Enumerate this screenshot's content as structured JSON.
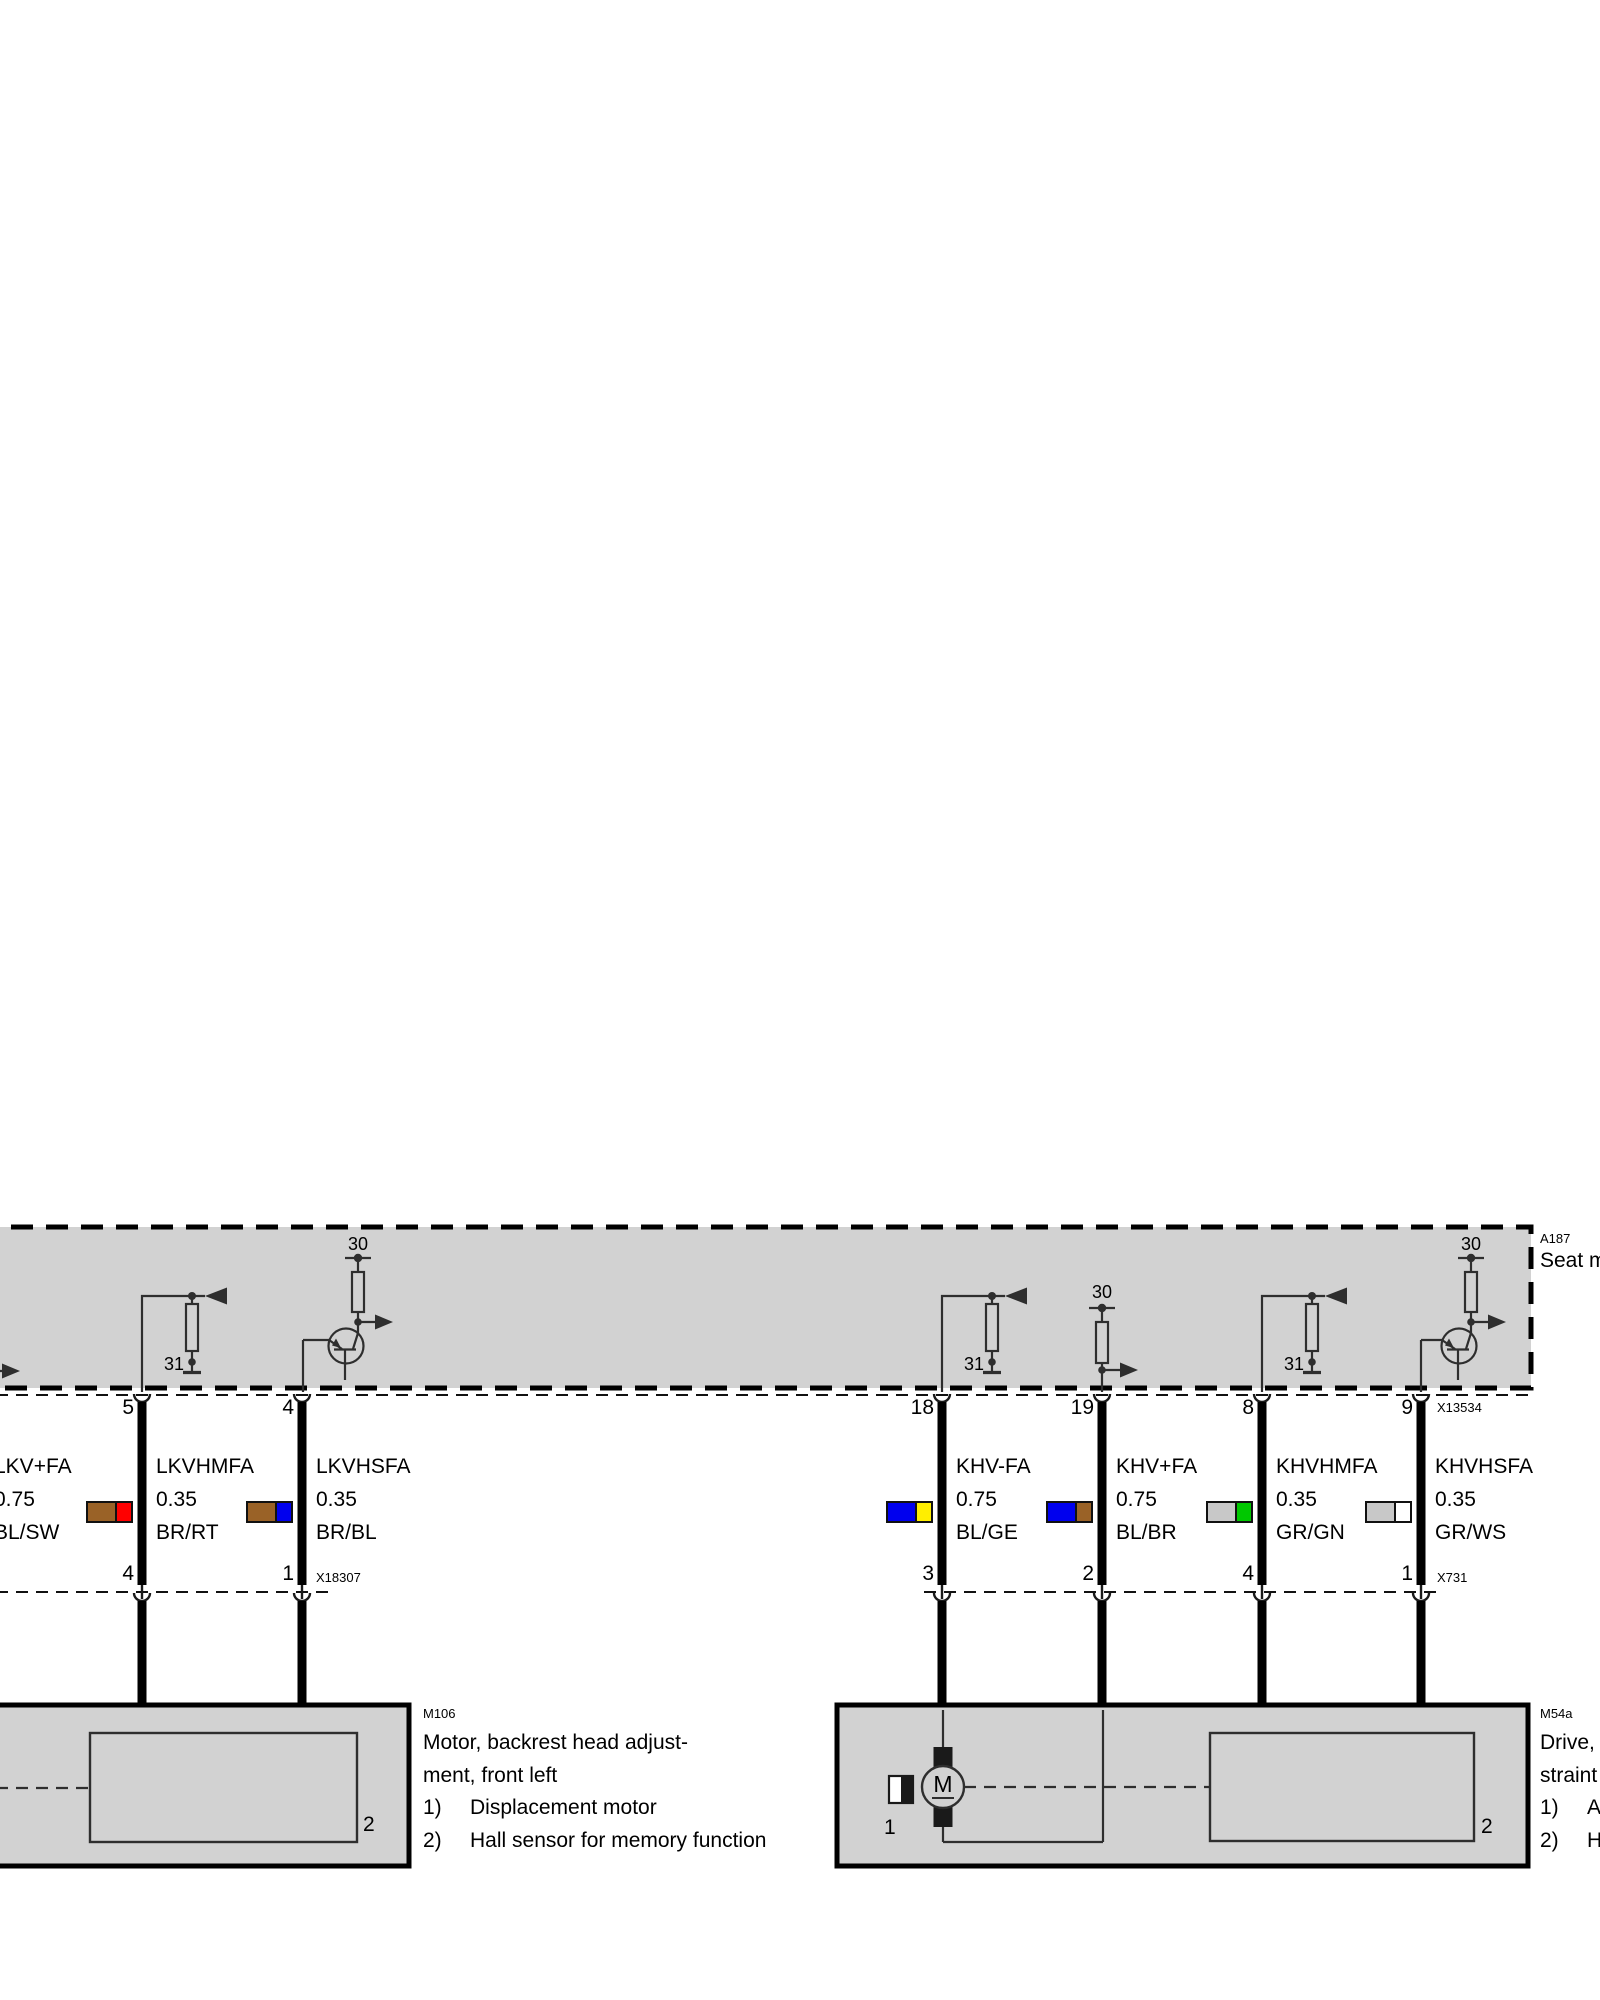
{
  "module": {
    "code": "A187",
    "name": "Seat m",
    "connector_top": "X13534"
  },
  "terminals": {
    "power": "30",
    "ground": "31"
  },
  "groups": {
    "left": {
      "connector_bottom": "X18307",
      "wires": [
        {
          "label": "LKV+FA",
          "gauge": "0.75",
          "color_code": "BL/SW",
          "colors": [
            "BL",
            "SW"
          ]
        },
        {
          "label": "LKVHMFA",
          "gauge": "0.35",
          "color_code": "BR/RT",
          "colors": [
            "BR",
            "RT"
          ],
          "pin_top": "5",
          "pin_bottom": "4"
        },
        {
          "label": "LKVHSFA",
          "gauge": "0.35",
          "color_code": "BR/BL",
          "colors": [
            "BR",
            "BL"
          ],
          "pin_top": "4",
          "pin_bottom": "1"
        }
      ]
    },
    "right": {
      "connector_bottom": "X731",
      "wires": [
        {
          "label": "KHV-FA",
          "gauge": "0.75",
          "color_code": "BL/GE",
          "colors": [
            "BL",
            "GE"
          ],
          "pin_top": "18",
          "pin_bottom": "3"
        },
        {
          "label": "KHV+FA",
          "gauge": "0.75",
          "color_code": "BL/BR",
          "colors": [
            "BL",
            "BR"
          ],
          "pin_top": "19",
          "pin_bottom": "2"
        },
        {
          "label": "KHVHMFA",
          "gauge": "0.35",
          "color_code": "GR/GN",
          "colors": [
            "GR",
            "GN"
          ],
          "pin_top": "8",
          "pin_bottom": "4"
        },
        {
          "label": "KHVHSFA",
          "gauge": "0.35",
          "color_code": "GR/WS",
          "colors": [
            "GR",
            "WS"
          ],
          "pin_top": "9",
          "pin_bottom": "1"
        }
      ]
    }
  },
  "components": {
    "m106": {
      "code": "M106",
      "name_lines": [
        "Motor, backrest head adjust-",
        "ment, front left"
      ],
      "items": [
        {
          "num": "1)",
          "text": "Displacement motor"
        },
        {
          "num": "2)",
          "text": "Hall sensor for memory function"
        }
      ],
      "part_labels": {
        "hall": "2"
      }
    },
    "m54a": {
      "code": "M54a",
      "name_lines": [
        "Drive,",
        "straint"
      ],
      "items": [
        {
          "num": "1)",
          "text": "Ad"
        },
        {
          "num": "2)",
          "text": "Ha"
        }
      ],
      "part_labels": {
        "motor": "1",
        "hall": "2"
      },
      "motor_symbol": "M"
    }
  },
  "swatch_palette": {
    "BL": "#0000ee",
    "SW": "#000000",
    "BR": "#9a6227",
    "RT": "#ff0000",
    "GE": "#ffee00",
    "GN": "#00c800",
    "GR": "#c8c8c8",
    "WS": "#ffffff"
  }
}
